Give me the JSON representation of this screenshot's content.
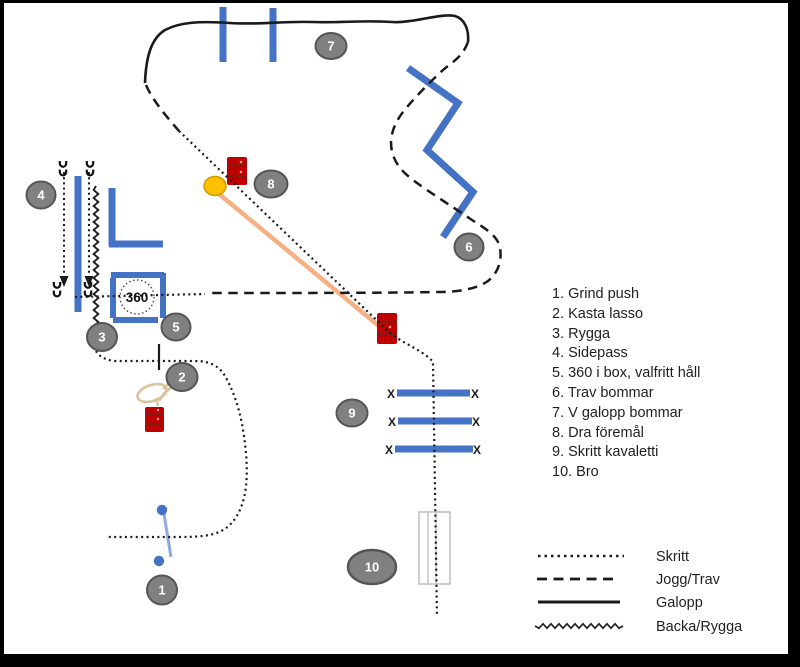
{
  "exercises": [
    "1. Grind push",
    "2. Kasta lasso",
    "3. Rygga",
    "4. Sidepass",
    "5. 360 i box, valfritt håll",
    "6. Trav bommar",
    "7. V galopp bommar",
    "8. Dra föremål",
    "9. Skritt kavaletti",
    "10. Bro"
  ],
  "markers": [
    "1",
    "2",
    "3",
    "4",
    "5",
    "6",
    "7",
    "8",
    "9",
    "10"
  ],
  "box_label": "360",
  "kavaletti_marker": "X",
  "legend": {
    "items": [
      {
        "style": "dotted",
        "label": "Skritt"
      },
      {
        "style": "dashed",
        "label": "Jogg/Trav"
      },
      {
        "style": "solid",
        "label": "Galopp"
      },
      {
        "style": "zigzag",
        "label": "Backa/Rygga"
      }
    ]
  },
  "colors": {
    "pole_blue": "#4472c4",
    "gate_line_blue": "#8faadc",
    "barrel_red": "#c00000",
    "marker_gray": "#808080",
    "drag_rope_orange": "#f5b183",
    "ball_yellow": "#ffc000",
    "path_black": "#1a1a1a"
  }
}
